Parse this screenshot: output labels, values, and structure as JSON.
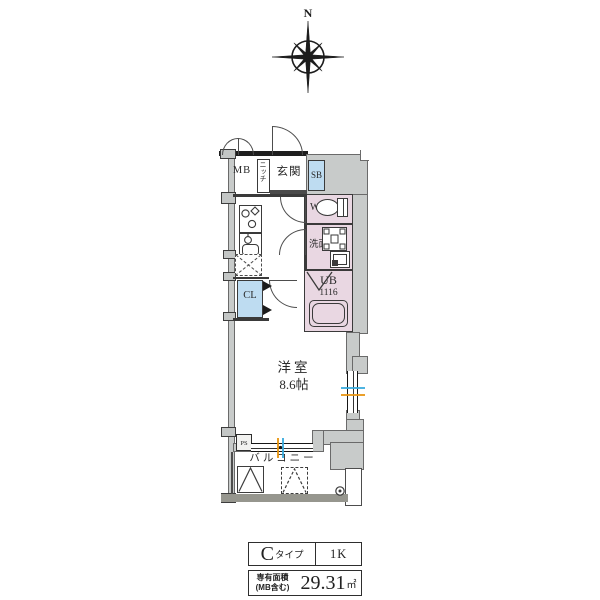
{
  "compass": {
    "north_label": "N"
  },
  "floorplan": {
    "labels": {
      "mb": "MB",
      "niche": "ニッチ",
      "entrance": "玄関",
      "shoe_box": "SB",
      "toilet": "WC",
      "washroom": "洗面",
      "unit_bath": "UB",
      "unit_bath_size": "1116",
      "closet": "CL",
      "room": "洋室",
      "room_size": "8.6帖",
      "pipe_space": "PS",
      "balcony": "バルコニー"
    },
    "colors": {
      "wall": "#c8cbca",
      "wet_area_pink": "#e9d7e2",
      "storage_blue": "#bedcf1",
      "balcony_edge": "#96968e",
      "sash_blue": "#35aadd",
      "sash_orange": "#e8930c"
    }
  },
  "info_table": {
    "type_letter": "C",
    "type_suffix": "タイプ",
    "layout_type": "1K",
    "area_label_line1": "専有面積",
    "area_label_line2": "(MB含む)",
    "area_value": "29.31",
    "area_unit": "㎡"
  }
}
